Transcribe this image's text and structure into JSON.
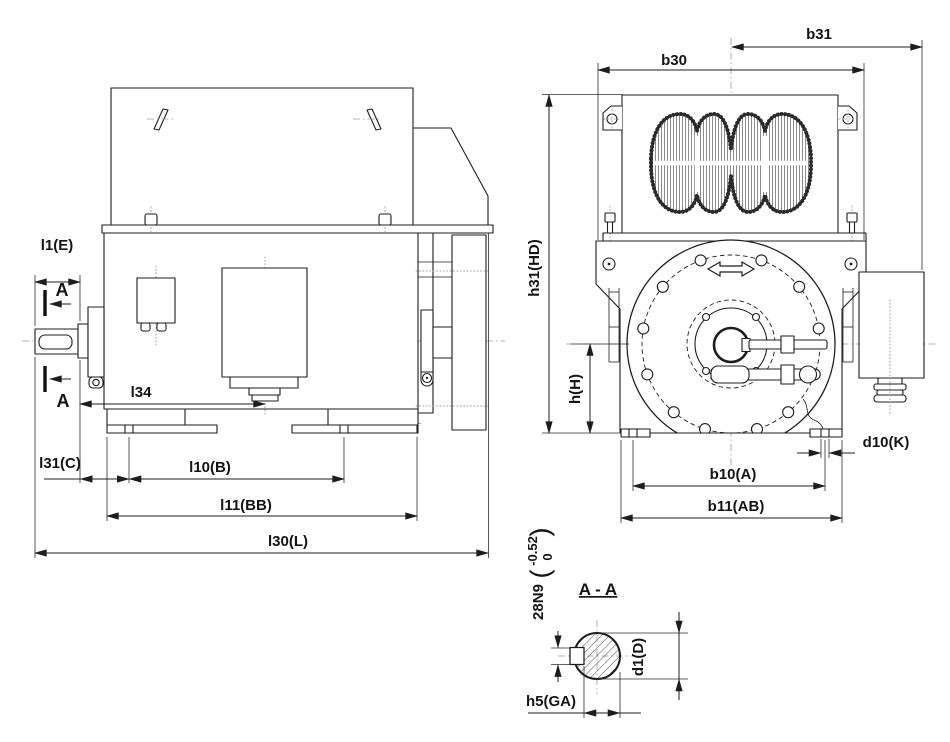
{
  "drawing": {
    "kind": "technical-dimension-drawing",
    "subject": "electric-motor-outline",
    "colors": {
      "line": "#1d1d1d",
      "centerline": "#9b9b9b",
      "background": "#ffffff"
    },
    "labels": {
      "side": {
        "l1": "l1(E)",
        "section_marker_top": "A",
        "section_marker_bottom": "A",
        "l34": "l34",
        "l31": "l31(C)",
        "l10": "l10(B)",
        "l11": "l11(BB)",
        "l30": "l30(L)"
      },
      "front": {
        "b31": "b31",
        "b30": "b30",
        "h31": "h31(HD)",
        "h": "h(H)",
        "d10": "d10(K)",
        "b10": "b10(A)",
        "b11": "b11(AB)"
      },
      "section": {
        "title": "A - A",
        "key_width": "28N9",
        "tol_open": "(",
        "tol_upper": "0",
        "tol_lower": "-0.52",
        "tol_close": ")",
        "d1": "d1(D)",
        "h5": "h5(GA)"
      }
    }
  }
}
